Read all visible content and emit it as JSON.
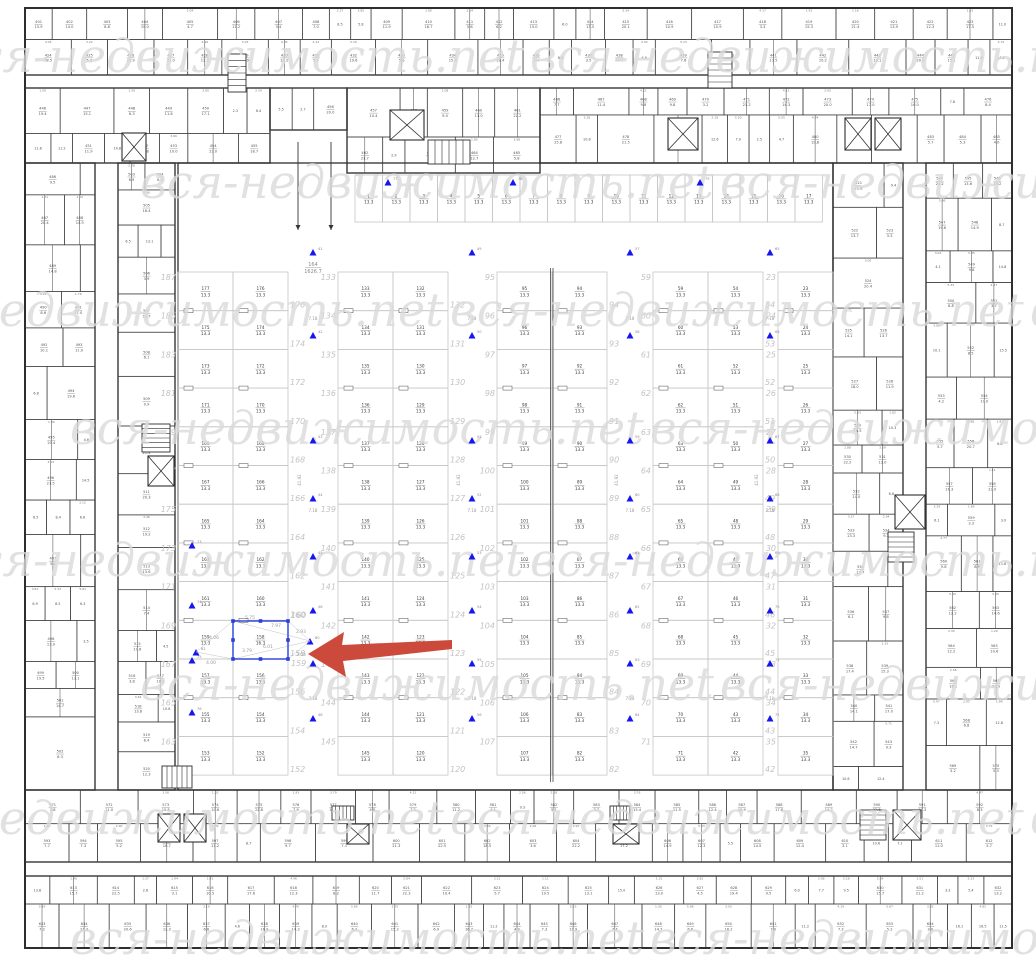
{
  "canvas": {
    "width": 1036,
    "height": 960,
    "background": "#ffffff"
  },
  "colors": {
    "wall": "#2e2e2e",
    "room_line": "#404040",
    "room_text": "#555555",
    "stall_line": "#c6c6c6",
    "stall_text": "#3b3b3b",
    "italic_num": "#c3c3c3",
    "watermark": "#dadada",
    "marker": "#1616ee",
    "marker_num": "#8a8a8a",
    "selection": "#2b3fd9",
    "dim_text": "#9a9a9a",
    "dim_line": "#c2c2c2",
    "hall_text": "#8a8a8a",
    "arrow": "#cc4a3c",
    "tick": "#6a6a6a"
  },
  "watermark": {
    "text": "вся-недвижимость.net",
    "font_size": 46,
    "tile_step": 580,
    "rows": [
      {
        "y": 72,
        "x0": -50
      },
      {
        "y": 198,
        "x0": 140
      },
      {
        "y": 326,
        "x0": -130
      },
      {
        "y": 444,
        "x0": 70
      },
      {
        "y": 576,
        "x0": -50
      },
      {
        "y": 700,
        "x0": 140
      },
      {
        "y": 834,
        "x0": -130
      },
      {
        "y": 954,
        "x0": 70
      }
    ]
  },
  "building": {
    "outer": [
      25,
      8,
      987,
      940
    ],
    "courtyard": [
      178,
      163,
      655,
      627
    ],
    "center_wall": {
      "x": 551.5,
      "y1": 268,
      "y2": 782
    },
    "ring_zones": [
      [
        25,
        8,
        987,
        67
      ],
      [
        25,
        88,
        245,
        75
      ],
      [
        270,
        88,
        77,
        42
      ],
      [
        347,
        88,
        193,
        85
      ],
      [
        540,
        88,
        472,
        75
      ],
      [
        25,
        163,
        70,
        627
      ],
      [
        118,
        163,
        57,
        627
      ],
      [
        833,
        163,
        70,
        627
      ],
      [
        926,
        163,
        86,
        627
      ],
      [
        25,
        790,
        987,
        72
      ],
      [
        25,
        876,
        987,
        72
      ]
    ],
    "elevators": [
      [
        122,
        133,
        24,
        28
      ],
      [
        390,
        110,
        34,
        30
      ],
      [
        668,
        118,
        30,
        32
      ],
      [
        845,
        118,
        26,
        32
      ],
      [
        875,
        118,
        26,
        32
      ],
      [
        148,
        456,
        26,
        30
      ],
      [
        895,
        495,
        30,
        34
      ],
      [
        158,
        814,
        22,
        28
      ],
      [
        184,
        814,
        22,
        28
      ],
      [
        347,
        824,
        22,
        20
      ],
      [
        613,
        824,
        26,
        20
      ],
      [
        893,
        810,
        28,
        30
      ]
    ],
    "stairs": [
      [
        228,
        54,
        18,
        38,
        "v"
      ],
      [
        428,
        140,
        42,
        24,
        "h"
      ],
      [
        708,
        52,
        24,
        36,
        "v"
      ],
      [
        142,
        424,
        28,
        28,
        "v"
      ],
      [
        888,
        532,
        26,
        30,
        "v"
      ],
      [
        162,
        766,
        30,
        22,
        "h"
      ],
      [
        332,
        806,
        22,
        14,
        "h"
      ],
      [
        610,
        806,
        20,
        14,
        "h"
      ],
      [
        860,
        810,
        26,
        30,
        "v"
      ]
    ],
    "ramp_arrows": [
      [
        298,
        142,
        230
      ],
      [
        331,
        142,
        230
      ]
    ]
  },
  "parking": {
    "area_label": "13.3",
    "grid": {
      "y0": 272,
      "rows": 13,
      "row_h": 38.7,
      "col_w": 55
    },
    "top_row": {
      "x": 355,
      "y": 175,
      "height": 47,
      "count": 17,
      "width": 27.5,
      "start_num": 1
    },
    "strips": [
      {
        "x": 178,
        "cols": [
          {
            "start": 177,
            "step": -2
          },
          {
            "start": 176,
            "step": -2
          }
        ],
        "italic_left": {
          "start": 187,
          "step": -2
        },
        "italic_right": {
          "start": 176,
          "step": -2
        }
      },
      {
        "x": 338,
        "cols": [
          {
            "start": 133,
            "step": 1
          },
          {
            "start": 132,
            "step": -1
          }
        ],
        "italic_left": {
          "start": 133,
          "step": 1
        },
        "italic_right": {
          "start": 132,
          "step": -1
        }
      },
      {
        "x": 497,
        "cols": [
          {
            "start": 95,
            "step": 1
          },
          {
            "start": 94,
            "step": -1
          }
        ],
        "italic_left": {
          "start": 95,
          "step": 1
        },
        "italic_right": {
          "start": 94,
          "step": -1
        }
      },
      {
        "x": 653,
        "cols": [
          {
            "start": 59,
            "step": 1
          },
          {
            "start": 54,
            "step": -1
          }
        ],
        "italic_left": {
          "start": 59,
          "step": 1
        },
        "italic_right": {
          "start": 54,
          "step": -1
        }
      },
      {
        "x": 778,
        "cols": [
          {
            "start": 23,
            "step": 1
          }
        ],
        "italic_left": {
          "start": 23,
          "step": 1
        },
        "italic_right": null
      }
    ],
    "aisles": {
      "xs": [
        313,
        472,
        630,
        770
      ],
      "width_label": "7.18",
      "label_ys": [
        320,
        512,
        700
      ],
      "vertical_label": "41.92",
      "vertical_label_y": 480,
      "marker_ys": [
        252,
        335,
        440,
        498,
        556,
        610,
        663,
        718
      ]
    },
    "extra_markers": [
      [
        192,
        545
      ],
      [
        192,
        605
      ],
      [
        192,
        660
      ],
      [
        192,
        712
      ],
      [
        388,
        182
      ],
      [
        513,
        182
      ],
      [
        700,
        182
      ]
    ],
    "marker_start_num": 41,
    "hall_label": {
      "number": "164",
      "area": "1626.7",
      "x": 313,
      "y": 266
    }
  },
  "selection": {
    "rect": [
      233,
      621,
      55,
      38
    ],
    "number": "158",
    "area": "16.3",
    "grid_ref": {
      "strip": 0,
      "col": 1,
      "row": 9
    },
    "anchor_right": [
      310,
      641
    ],
    "anchor_left": [
      196,
      652
    ],
    "dims": [
      [
        "5.75",
        250,
        619
      ],
      [
        "7.97",
        276,
        627
      ],
      [
        "2.93",
        301,
        633
      ],
      [
        "3.04",
        301,
        656
      ],
      [
        "6.01",
        268,
        648
      ],
      [
        "3.79",
        247,
        652
      ],
      [
        "4.06",
        214,
        639
      ],
      [
        "4.00",
        211,
        664
      ]
    ],
    "context_numbers": [
      [
        "160",
        291,
        618
      ],
      [
        "159",
        291,
        666
      ]
    ]
  },
  "arrow": {
    "points": [
      [
        308,
        654
      ],
      [
        344,
        632
      ],
      [
        342,
        645
      ],
      [
        452,
        640
      ],
      [
        452,
        649
      ],
      [
        343,
        661
      ],
      [
        346,
        677
      ]
    ]
  }
}
